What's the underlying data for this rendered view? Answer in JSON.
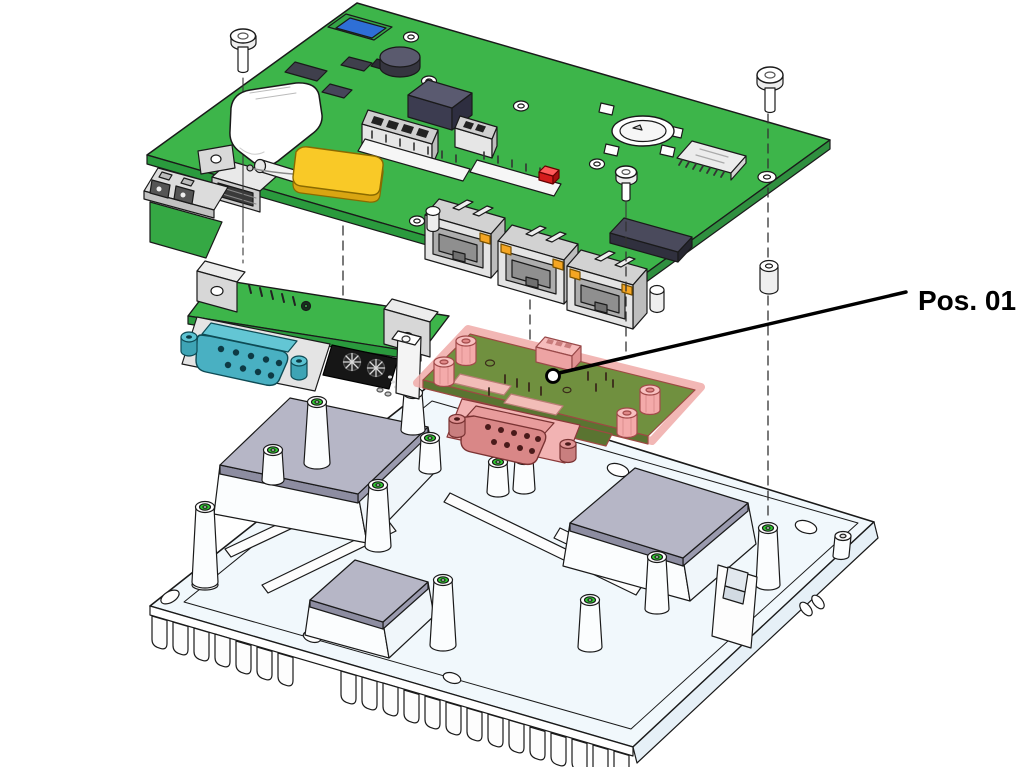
{
  "figure": {
    "type": "exploded-assembly-diagram",
    "background": "#ffffff",
    "callout": {
      "label": "Pos. 01"
    }
  },
  "parts": {
    "main_board": "main-pcb",
    "serial_daughterboard": "serial-dsub-daughterboard",
    "pos01_board": "highlighted-expansion-board",
    "heatsink_chassis": "finned-heatsink-base"
  },
  "colors": {
    "pcb_green": "#3DB54A",
    "pcb_green_edge": "#2A9A3D",
    "pos01_board_olive": "#70903F",
    "highlight_pink": "#F4AAAA",
    "highlight_outline": "#D96A6A",
    "serial_connector_teal": "#49B0C2",
    "antenna_yellow": "#F9C927",
    "status_led_red": "#D51C1C",
    "ethernet_led_orange": "#F5A623",
    "component_dark": "#4A4A5C",
    "thermal_pad_gray": "#B6B6C6",
    "heatsink_fill": "#F1F8FC",
    "post_hole_green": "#2FD02F",
    "line_black": "#000000"
  }
}
